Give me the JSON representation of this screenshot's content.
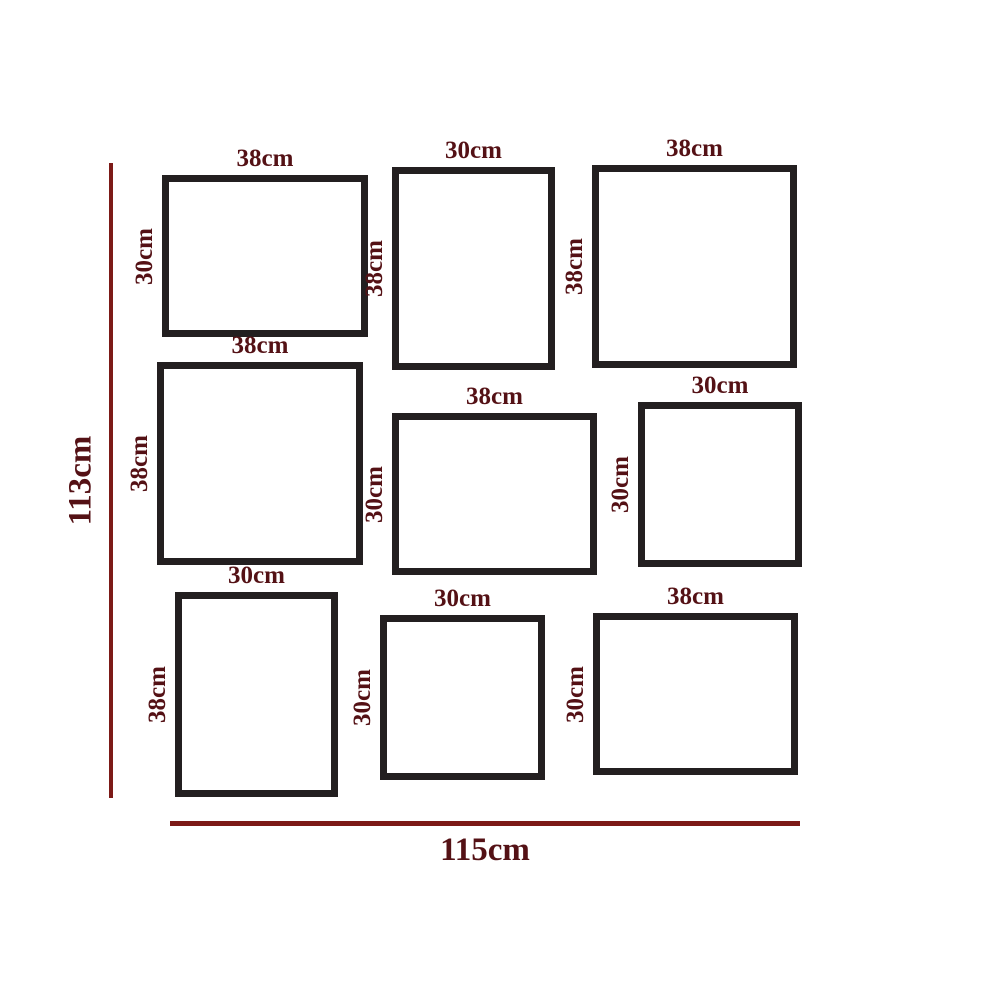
{
  "canvas": {
    "width": 1000,
    "height": 1000,
    "background": "#ffffff"
  },
  "colors": {
    "frame_border": "#231f20",
    "dimension_text": "#541115",
    "ruler_line": "#7c1a17"
  },
  "overall_dimensions": {
    "height": {
      "label": "113cm"
    },
    "width": {
      "label": "115cm"
    }
  },
  "frames": [
    {
      "name": "frame-top-left",
      "width_label": "38cm",
      "height_label": "30cm",
      "x": 162,
      "y": 175,
      "w": 206,
      "h": 162
    },
    {
      "name": "frame-top-middle",
      "width_label": "30cm",
      "height_label": "38cm",
      "x": 392,
      "y": 167,
      "w": 163,
      "h": 203
    },
    {
      "name": "frame-top-right",
      "width_label": "38cm",
      "height_label": "38cm",
      "x": 592,
      "y": 165,
      "w": 205,
      "h": 203
    },
    {
      "name": "frame-middle-left",
      "width_label": "38cm",
      "height_label": "38cm",
      "x": 157,
      "y": 362,
      "w": 206,
      "h": 203
    },
    {
      "name": "frame-middle-center",
      "width_label": "38cm",
      "height_label": "30cm",
      "x": 392,
      "y": 413,
      "w": 205,
      "h": 162
    },
    {
      "name": "frame-middle-right",
      "width_label": "30cm",
      "height_label": "30cm",
      "x": 638,
      "y": 402,
      "w": 164,
      "h": 165
    },
    {
      "name": "frame-bottom-left",
      "width_label": "30cm",
      "height_label": "38cm",
      "x": 175,
      "y": 592,
      "w": 163,
      "h": 205
    },
    {
      "name": "frame-bottom-middle",
      "width_label": "30cm",
      "height_label": "30cm",
      "x": 380,
      "y": 615,
      "w": 165,
      "h": 165
    },
    {
      "name": "frame-bottom-right",
      "width_label": "38cm",
      "height_label": "30cm",
      "x": 593,
      "y": 613,
      "w": 205,
      "h": 162
    }
  ]
}
